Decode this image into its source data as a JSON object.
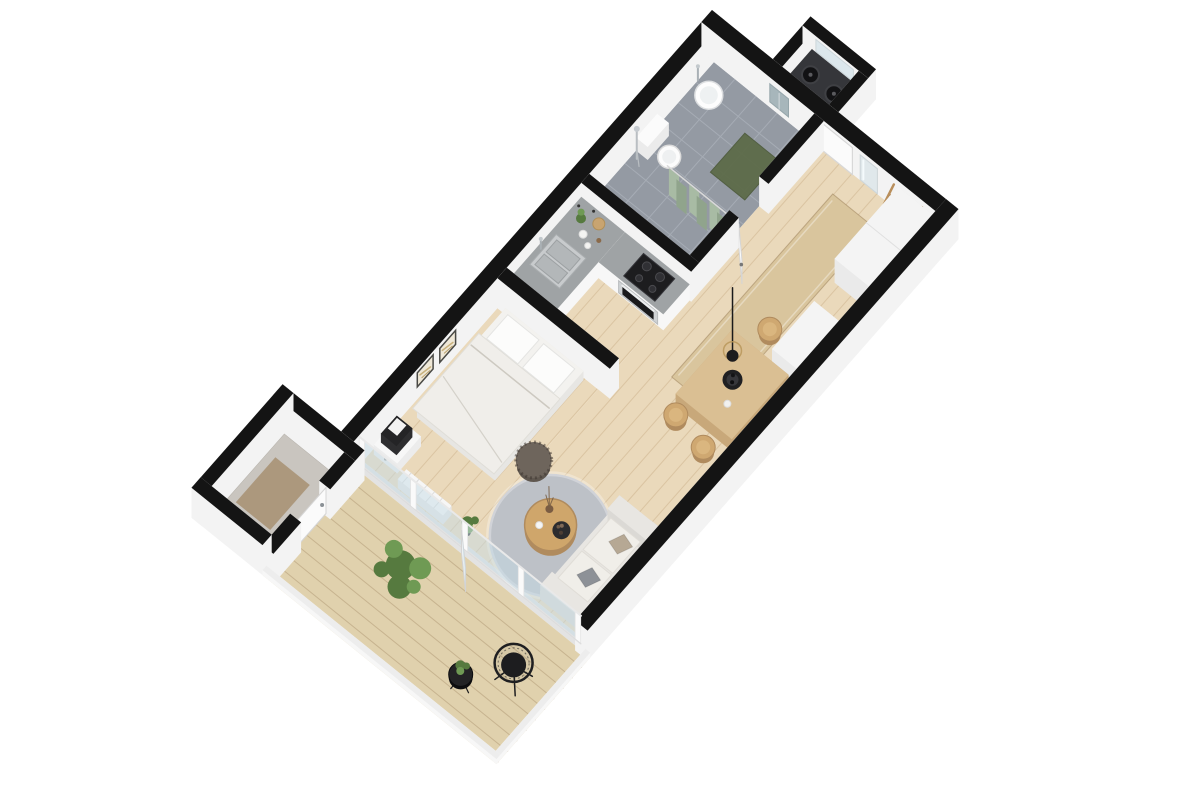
{
  "meta": {
    "label": "3D axonometric floor plan render of a studio apartment"
  },
  "palette": {
    "wallTop": "#141414",
    "wallSide": "#f3f3f3",
    "wood": "#ead9bb",
    "woodLine": "rgba(166,124,72,0.22)",
    "deck": "#e0d1ad",
    "deckLine": "rgba(122,92,56,0.25)",
    "tile": "#949aa3",
    "tileLine": "#a6acb5",
    "concrete": "#c9c5bf",
    "concreteMat": "#a89276",
    "cabinet": "#f7f7f7",
    "counterTop": "#9fa3a5",
    "steel": "#c8cbcd",
    "steelDark": "#a9adaf",
    "appliance": "#1d1d1f",
    "ovenSteel": "#cfd2d4",
    "tableWood": "#dabf93",
    "tableSide": "#c8a87a",
    "chairWood": "#cfa871",
    "chairInner": "#dab67f",
    "rug": "#bdc1c7",
    "runner": "#d9c59d",
    "bathMat": "#5d6b49",
    "curtain": "#a8bba4",
    "curtainDark": "#90a48c",
    "towel": "#a7b6bb",
    "sofa": "#e8e6e2",
    "sofaSide": "#dbd9d5",
    "cushion": "#f0eee9",
    "pillowGray": "#8d9197",
    "pillowTan": "#b6a894",
    "bedBase": "#f3f2ef",
    "bedSide": "#e7e6e3",
    "duvet": "#f0eeea",
    "pillow": "#fcfcfb",
    "green": "#567a3f",
    "greenLight": "#6f9a54",
    "trunk": "#5b4632",
    "pouf": "#6e655c",
    "hat": "#cdb58d",
    "glass": "rgba(198,219,229,0.5)",
    "mirror": "#e0e8eb",
    "doorLeaf": "#fbfbfb",
    "washerTop": "#35363a",
    "radiator": "#f6f6f6",
    "coffeeWood": "#cfa66b",
    "art": "#efe8d8",
    "artFrame": "#4a4a46",
    "fascia": "#ededed",
    "black": "#1c1c1e"
  },
  "scene": {
    "rooms": [
      {
        "name": "entrance-hall",
        "floor": "wood"
      },
      {
        "name": "bathroom",
        "floor": "tile"
      },
      {
        "name": "kitchen",
        "floor": "wood"
      },
      {
        "name": "dining-area",
        "floor": "wood"
      },
      {
        "name": "bedroom-living-area",
        "floor": "wood"
      },
      {
        "name": "balcony",
        "floor": "deck"
      },
      {
        "name": "storage-room",
        "floor": "concrete"
      }
    ],
    "furniture": [
      "washer-niche",
      "glass-shelf",
      "entry-door",
      "wall-mirror",
      "coat-rack-with-hat",
      "hall-wardrobe",
      "runner-rug",
      "bathroom-sink",
      "towel",
      "toilet",
      "shower-set",
      "shower-curtain",
      "bath-mat",
      "kitchen-counter",
      "kitchen-sink",
      "cooktop",
      "oven",
      "counter-decor",
      "dining-table",
      "dining-chair",
      "pendant-lamp",
      "decor-bowl",
      "sideboard",
      "partition-wall",
      "double-bed",
      "pillows",
      "duvet",
      "nightstand",
      "black-cabinet-box",
      "wall-art",
      "floor-pouf",
      "round-rug",
      "coffee-table",
      "candle",
      "serving-tray",
      "vase-with-branches",
      "radiator",
      "indoor-plant",
      "sofa",
      "sofa-cushions",
      "glazed-balcony-wall",
      "balcony-door",
      "storage-door",
      "potted-plant-large",
      "wire-chair",
      "wire-side-table",
      "side-table-plant",
      "deck-fascia"
    ]
  }
}
